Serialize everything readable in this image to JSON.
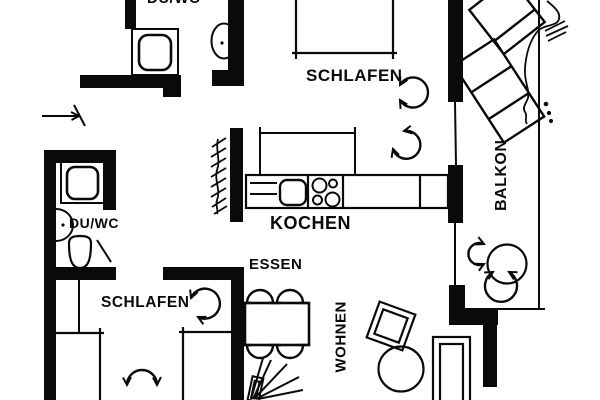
{
  "colors": {
    "ink": "#0a0a0a",
    "paper": "#ffffff"
  },
  "labels": {
    "bath_top": "DU/WC",
    "bedroom_top": "SCHLAFEN",
    "kitchen": "KOCHEN",
    "dining": "ESSEN",
    "bath_left": "DU/WC",
    "bedroom_left": "SCHLAFEN",
    "living": "WOHNEN",
    "balcony": "BALKON"
  }
}
